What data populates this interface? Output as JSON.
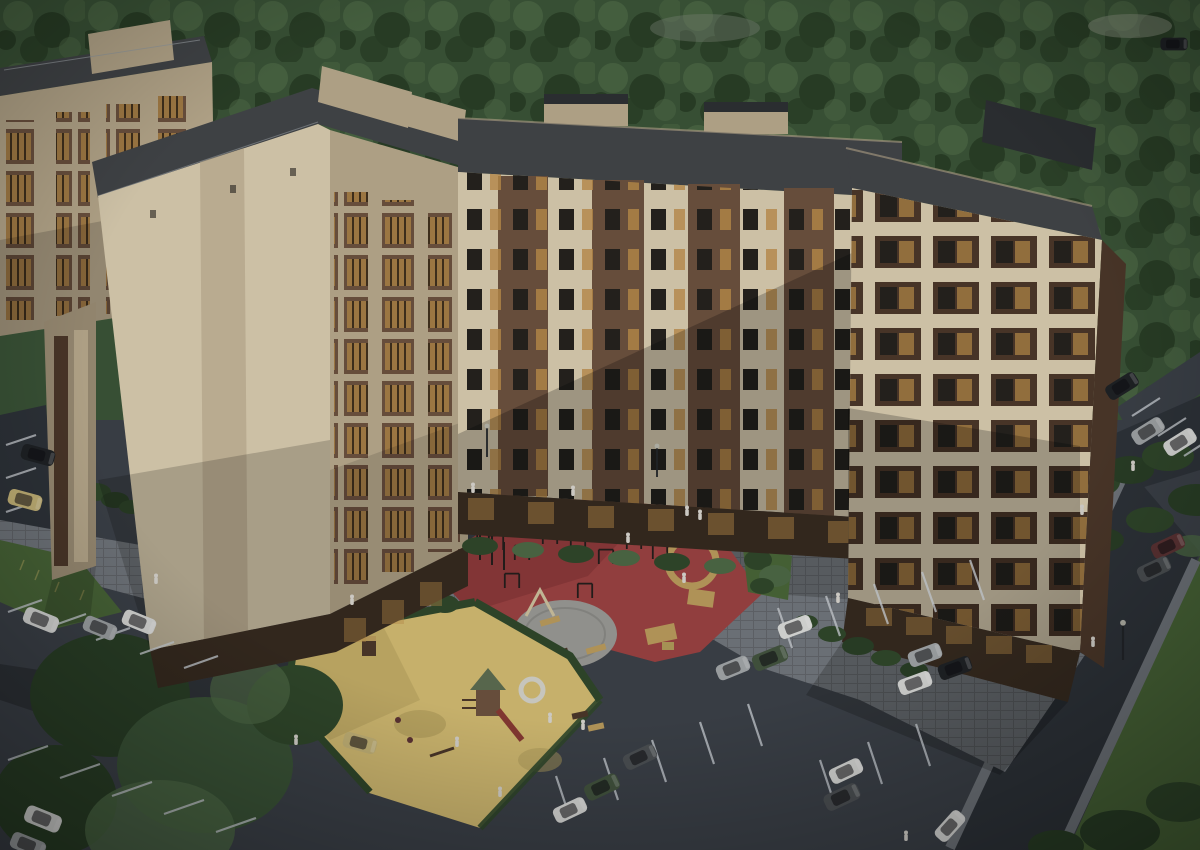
{
  "scene": {
    "type": "3d-architectural-render",
    "view": "aerial-oblique",
    "subject": "residential apartment complex with courtyard, playgrounds and parking",
    "lighting": "daytime, dimmed render with darkened vignette",
    "areas": {
      "background": "dense forest band",
      "buildings": [
        "far-left-slab",
        "left-tower-blank-wall",
        "center-long-slab",
        "right-tower"
      ],
      "facade_style": "cream and brown brick panels, amber-lit balconies, dark flat roofs, dark brick ground floors",
      "courtyard": "gray paver plaza with bushes and street lamps",
      "sports_playground": "red rubber surface with workout bars, tan ring, gray circular plaza with benches",
      "kids_playground": "yellow sand area with wooden play tower, green roof, red slide, white ring tunnel",
      "parking": "angled stalls bottom-left and bottom-right, perimeter roads right side",
      "greenery": "large trees bottom-left, hedge strips, lawns along right edge"
    },
    "counts": {
      "buildings": 4,
      "cars": 26,
      "people": 18,
      "street_lamps": 3,
      "playgrounds": 2
    }
  },
  "colors": {
    "forest": "#3c5639",
    "forest_light": "#4e6a46",
    "forest_dark": "#2b4027",
    "lawn": "#4a6739",
    "bush": "#31492c",
    "cream": "#dccfb2",
    "cream_shade": "#bbac8f",
    "cream_dark": "#9d8f76",
    "brown": "#6e5340",
    "brown_dark": "#4d392b",
    "brick": "#362a20",
    "roof": "#43464a",
    "roof_dark": "#2e3134",
    "win_dark": "#26231f",
    "win_lit": "#c0914c",
    "pavers": "#73787e",
    "pavers_shade": "#5a5f65",
    "asphalt": "#3d424a",
    "asphalt_dark": "#2f343b",
    "red": "#9d4343",
    "red_shade": "#7b3234",
    "sand": "#d5be74",
    "sand_shade": "#b29d5b",
    "plaza": "#9b9b97",
    "tan": "#bd9e5e",
    "line": "#c9ced3",
    "car_white": "#dddedc",
    "car_silver": "#a4a8ab",
    "car_black": "#202326",
    "car_dark": "#4e5256",
    "car_green": "#445640",
    "car_beige": "#c9b77a",
    "car_maroon": "#5f3536",
    "person": "#dbd8d1"
  }
}
